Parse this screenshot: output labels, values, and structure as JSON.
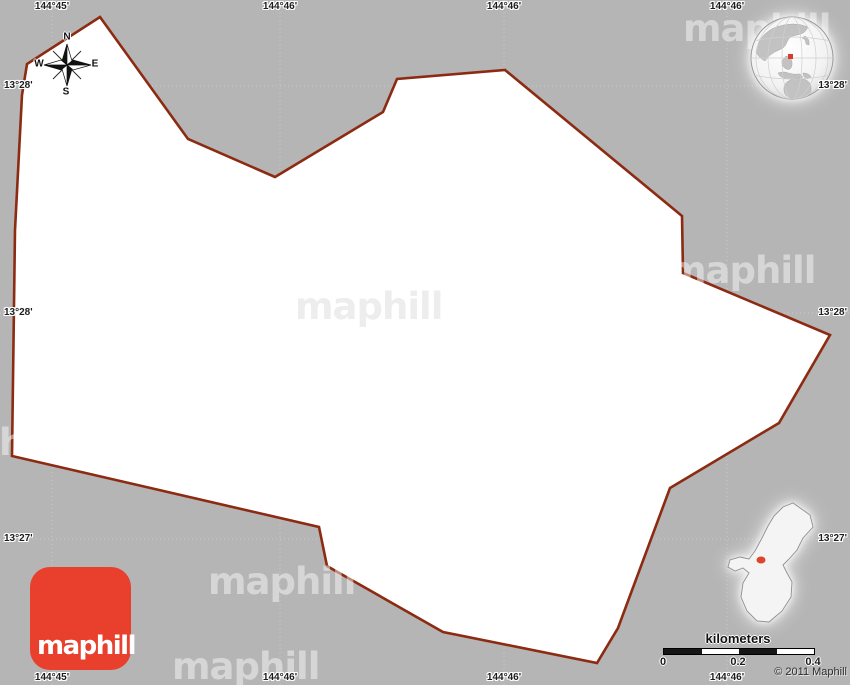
{
  "map": {
    "background_color": "#b5b5b5",
    "region_fill": "#ffffff",
    "region_border_color": "#8d2a12",
    "polygon_points": "100,17 188,139 275,177 383,112 397,79 505,70 682,216 683,273 830,335 779,423 670,488 618,628 597,663 443,632 327,566 319,527 12,456 15,230 22,95 27,64"
  },
  "grid": {
    "gridline_color": "#c9c9c9",
    "vertical_x": [
      52,
      280,
      504,
      727
    ],
    "horizontal_y": [
      86,
      313,
      539
    ],
    "lon_labels": [
      "144°45'",
      "144°46'",
      "144°46'",
      "144°46'"
    ],
    "lat_labels": [
      "13°28'",
      "13°28'",
      "13°27'"
    ]
  },
  "compass": {
    "north": "N",
    "east": "E",
    "south": "S",
    "west": "W"
  },
  "watermark": {
    "text": "maphill"
  },
  "logo": {
    "text": "maphill",
    "color": "#e8402c"
  },
  "globe_inset": {
    "marker_color": "#d93a2b",
    "land_color": "#c2c2c2"
  },
  "region_inset": {
    "marker_color": "#e04428",
    "island_fill": "#f4f4f4"
  },
  "scale": {
    "title": "kilometers",
    "ticks": [
      "0",
      "0.2",
      "0.4"
    ]
  },
  "copyright": "© 2011 Maphill"
}
